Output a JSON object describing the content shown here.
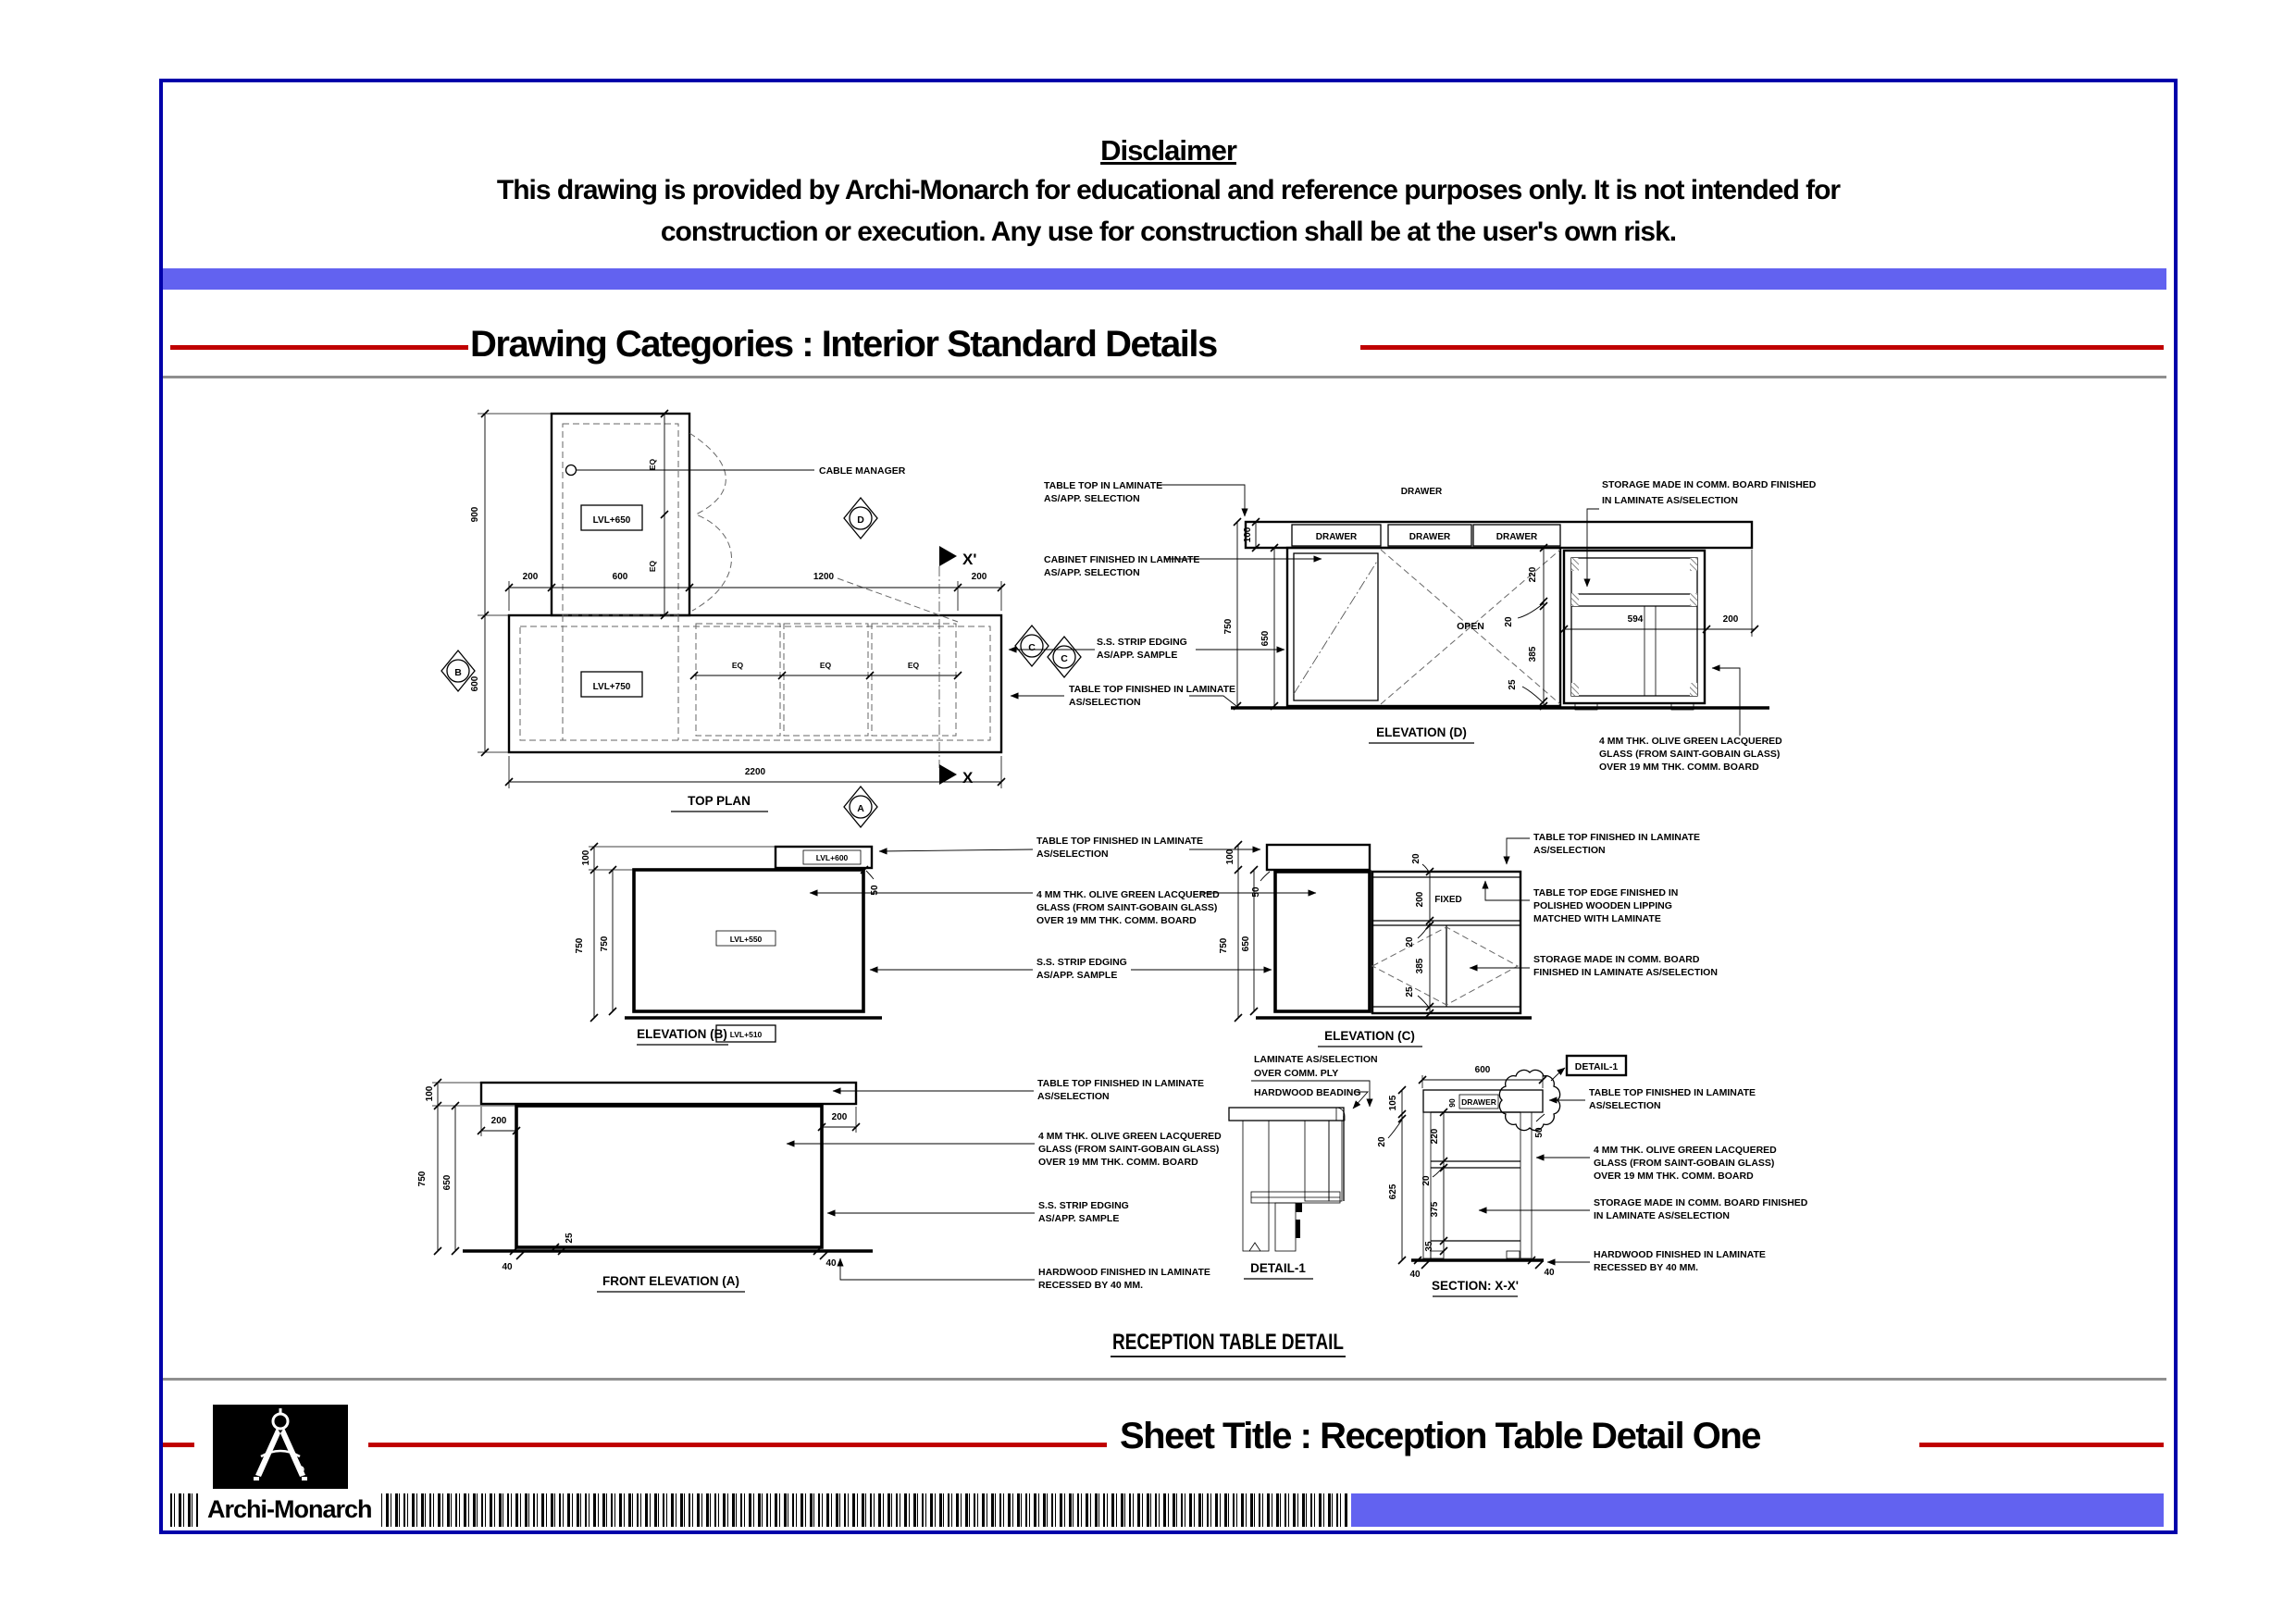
{
  "page": {
    "disclaimer": {
      "heading": "Disclaimer",
      "line1": "This drawing is provided by Archi-Monarch for educational and reference purposes only. It is not intended for",
      "line2": "construction or execution. Any use for construction shall be at the user's own risk."
    },
    "category_title": "Drawing Categories : Interior Standard Details",
    "sheet_title": "Sheet Title : Reception Table Detail One",
    "brand": "Archi-Monarch",
    "main_title": "RECEPTION TABLE DETAIL",
    "colors": {
      "accent_red": "#c00000",
      "banner_blue": "#6262f0",
      "border_blue": "#0000aa"
    }
  },
  "titles": {
    "top_plan": "TOP PLAN",
    "elevation_d": "ELEVATION (D)",
    "elevation_b": "ELEVATION (B)",
    "elevation_c": "ELEVATION (C)",
    "front_a": "FRONT ELEVATION (A)",
    "detail1": "DETAIL-1",
    "detail1_callout": "DETAIL-1",
    "section": "SECTION: X-X'"
  },
  "levels": {
    "l650": "LVL+650",
    "l750": "LVL+750",
    "l600": "LVL+600",
    "l550": "LVL+550",
    "l510": "LVL+510"
  },
  "markers": {
    "a": "A",
    "b": "B",
    "c": "C",
    "d": "D",
    "x": "X",
    "xp": "X'"
  },
  "dims": {
    "20": "20",
    "25": "25",
    "35": "35",
    "40": "40",
    "50": "50",
    "90": "90",
    "100": "100",
    "105": "105",
    "200": "200",
    "220": "220",
    "375": "375",
    "385": "385",
    "594": "594",
    "600": "600",
    "625": "625",
    "650": "650",
    "750": "750",
    "900": "900",
    "1200": "1200",
    "2200": "2200"
  },
  "notes": {
    "cable_manager": "CABLE MANAGER",
    "drawer": "DRAWER",
    "open": "OPEN",
    "fixed": "FIXED",
    "eq": "EQ",
    "table_top_laminate": [
      "TABLE TOP IN LAMINATE",
      "AS/APP. SELECTION"
    ],
    "cabinet_laminate": [
      "CABINET FINISHED IN LAMINATE",
      "AS/APP. SELECTION"
    ],
    "ss_strip": [
      "S.S. STRIP EDGING",
      "AS/APP. SAMPLE"
    ],
    "table_top_finished": [
      "TABLE TOP FINISHED IN LAMINATE",
      "AS/SELECTION"
    ],
    "glass": [
      "4 MM THK. OLIVE GREEN LACQUERED",
      "GLASS (FROM SAINT-GOBAIN GLASS)",
      "OVER 19 MM THK. COMM. BOARD"
    ],
    "storage_finished": [
      "STORAGE MADE IN COMM. BOARD FINISHED",
      "IN LAMINATE AS/SELECTION"
    ],
    "storage_board": [
      "STORAGE MADE IN COMM. BOARD",
      "FINISHED IN LAMINATE AS/SELECTION"
    ],
    "table_edge": [
      "TABLE TOP EDGE FINISHED IN",
      "POLISHED WOODEN LIPPING",
      "MATCHED WITH LAMINATE"
    ],
    "hardwood_recessed": [
      "HARDWOOD FINISHED IN LAMINATE",
      "RECESSED BY 40 MM."
    ],
    "laminate_ply": [
      "LAMINATE AS/SELECTION",
      "OVER COMM. PLY"
    ],
    "hardwood_beading": "HARDWOOD BEADING"
  }
}
